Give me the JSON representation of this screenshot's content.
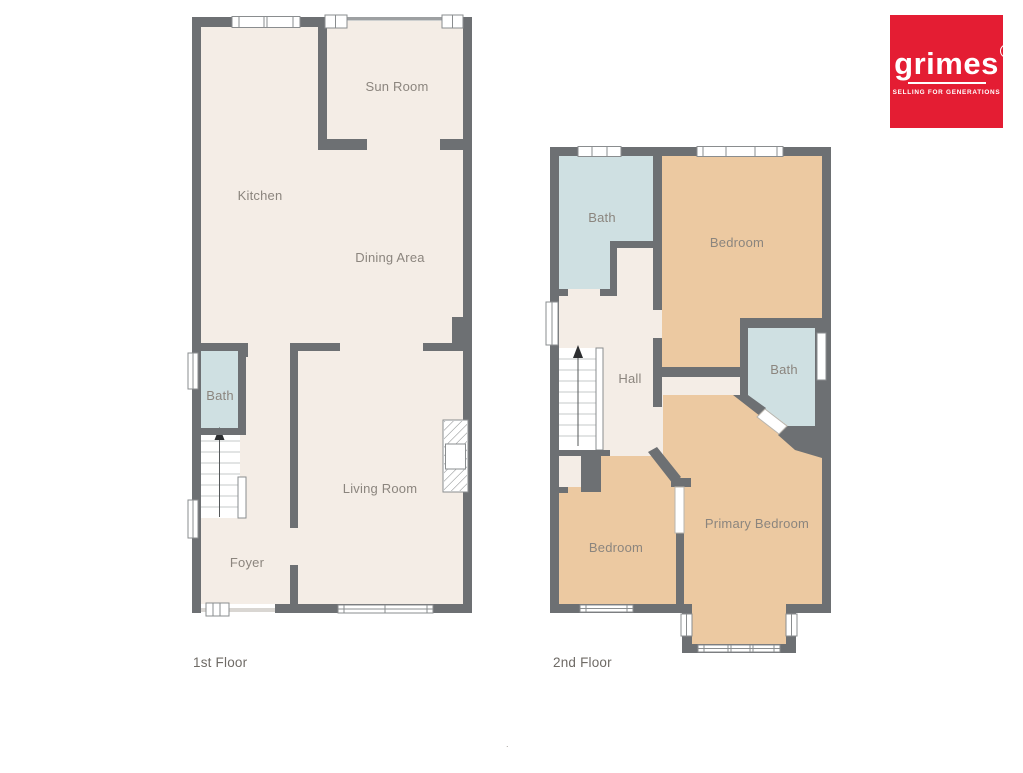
{
  "logo": {
    "brand": "grimes",
    "badge": "9",
    "tagline": "SELLING FOR GENERATIONS",
    "bg_color": "#e41d33",
    "text_color": "#ffffff"
  },
  "colors": {
    "wall": "#6d7073",
    "wall_light": "#9da0a2",
    "floor": "#f4ede6",
    "bath": "#cfe0e2",
    "bedroom": "#ecc9a1",
    "window": "#ffffff",
    "frame": "#8a8d8f",
    "tread": "#c6c8c9",
    "label": "#8b857e",
    "floor_label": "#6f6b66"
  },
  "stray_mark": ".",
  "floors": [
    {
      "label": "1st Floor",
      "rooms": [
        {
          "name": "Sun Room"
        },
        {
          "name": "Kitchen"
        },
        {
          "name": "Dining Area"
        },
        {
          "name": "Bath"
        },
        {
          "name": "Living Room"
        },
        {
          "name": "Foyer"
        }
      ]
    },
    {
      "label": "2nd Floor",
      "rooms": [
        {
          "name": "Bath"
        },
        {
          "name": "Bedroom"
        },
        {
          "name": "Hall"
        },
        {
          "name": "Bath"
        },
        {
          "name": "Bedroom"
        },
        {
          "name": "Primary Bedroom"
        }
      ]
    }
  ]
}
